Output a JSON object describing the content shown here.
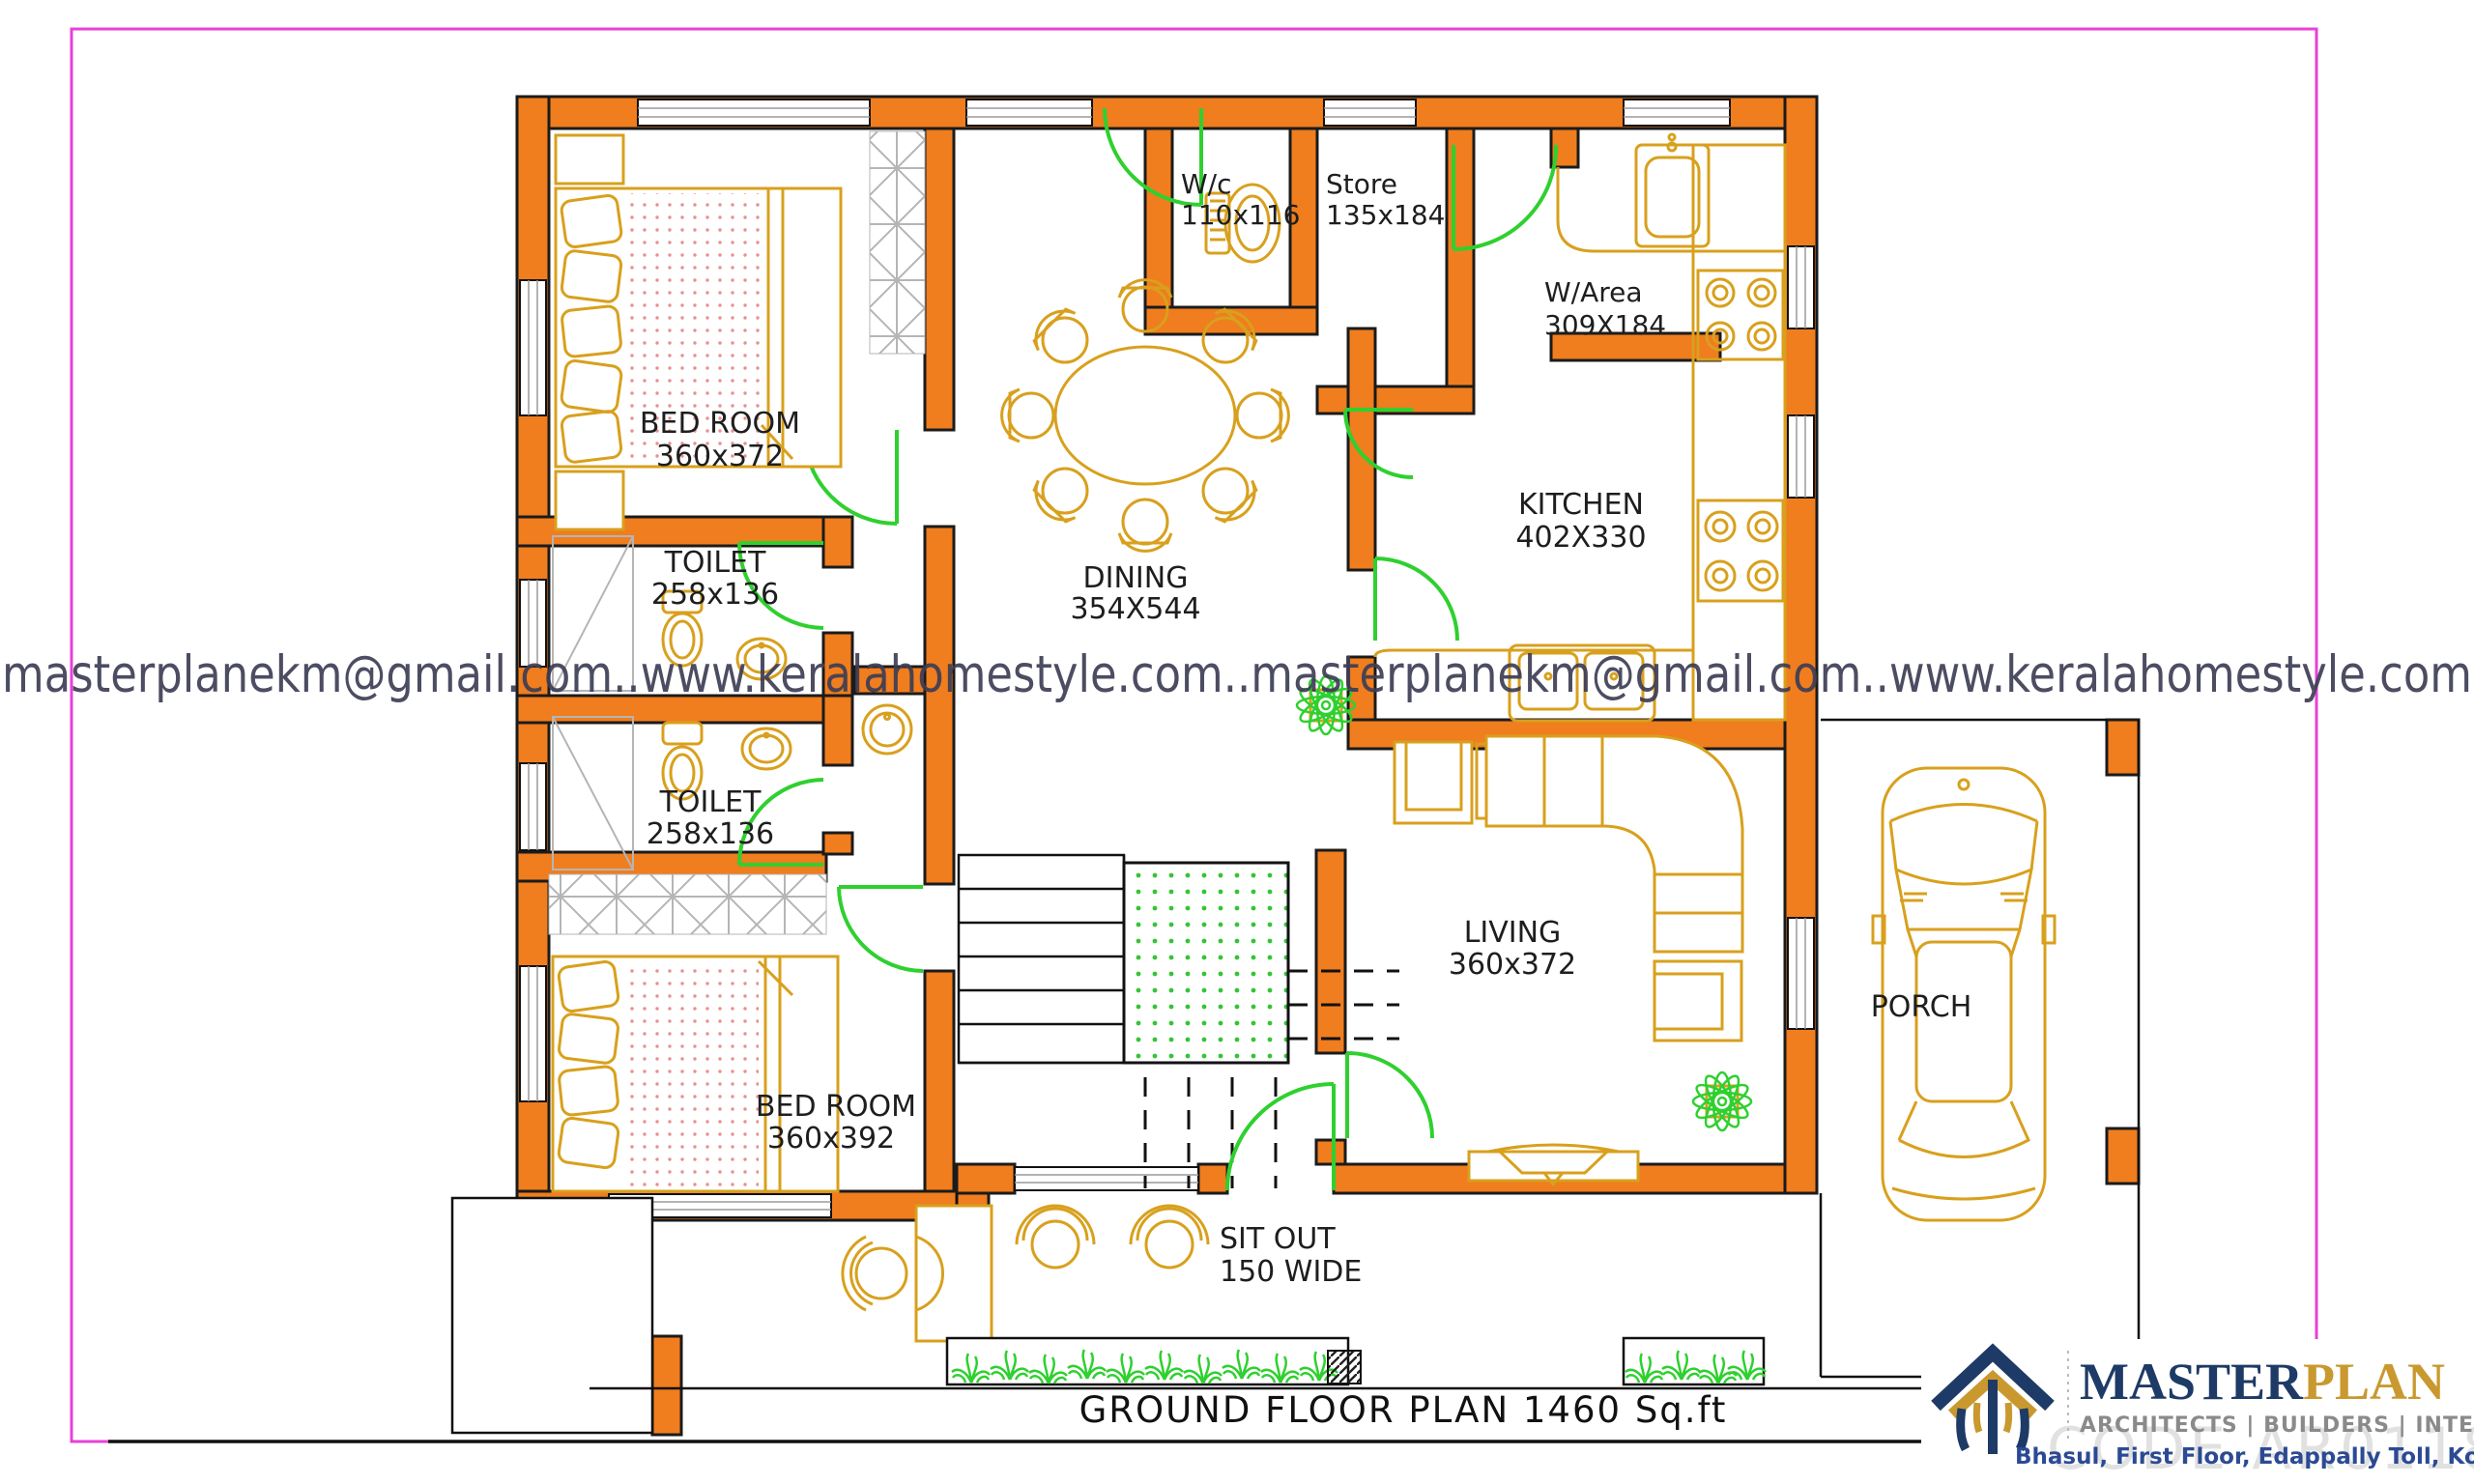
{
  "page": {
    "watermark_line": "masterplanekm@gmail.com..www.keralahomestyle.com..masterplanekm@gmail.com..www.keralahomestyle.com",
    "title": "GROUND FLOOR PLAN 1460 Sq.ft",
    "code_watermark": "CODE AR0118"
  },
  "rooms": {
    "bedroom1": {
      "name": "BED ROOM",
      "size": "360x372"
    },
    "toilet1": {
      "name": "TOILET",
      "size": "258x136"
    },
    "toilet2": {
      "name": "TOILET",
      "size": "258x136"
    },
    "bedroom2": {
      "name": "BED ROOM",
      "size": "360x392"
    },
    "dining": {
      "name": "DINING",
      "size": "354X544"
    },
    "wc": {
      "name": "W/c",
      "size": "110x116"
    },
    "store": {
      "name": "Store",
      "size": "135x184"
    },
    "warea": {
      "name": "W/Area",
      "size": "309X184"
    },
    "kitchen": {
      "name": "KITCHEN",
      "size": "402X330"
    },
    "living": {
      "name": "LIVING",
      "size": "360x372"
    },
    "porch": {
      "name": "PORCH"
    },
    "sitout": {
      "name": "SIT OUT",
      "size": "150 WIDE"
    }
  },
  "branding": {
    "name_primary": "MASTER",
    "name_secondary": "PLAN",
    "tagline": "ARCHITECTS | BUILDERS | INTERIORS",
    "address": "Bhasul, First Floor, Edappally Toll, Kochi-24. Ph 9447482396"
  },
  "colors": {
    "wall_orange": "#F07D1E",
    "furniture_gold": "#D8A01D",
    "door_green": "#2fd02f",
    "frame_pink": "#E840D8",
    "watermark_text": "#3d3d55",
    "logo_navy": "#1E3A66",
    "logo_gold": "#C9992F"
  }
}
